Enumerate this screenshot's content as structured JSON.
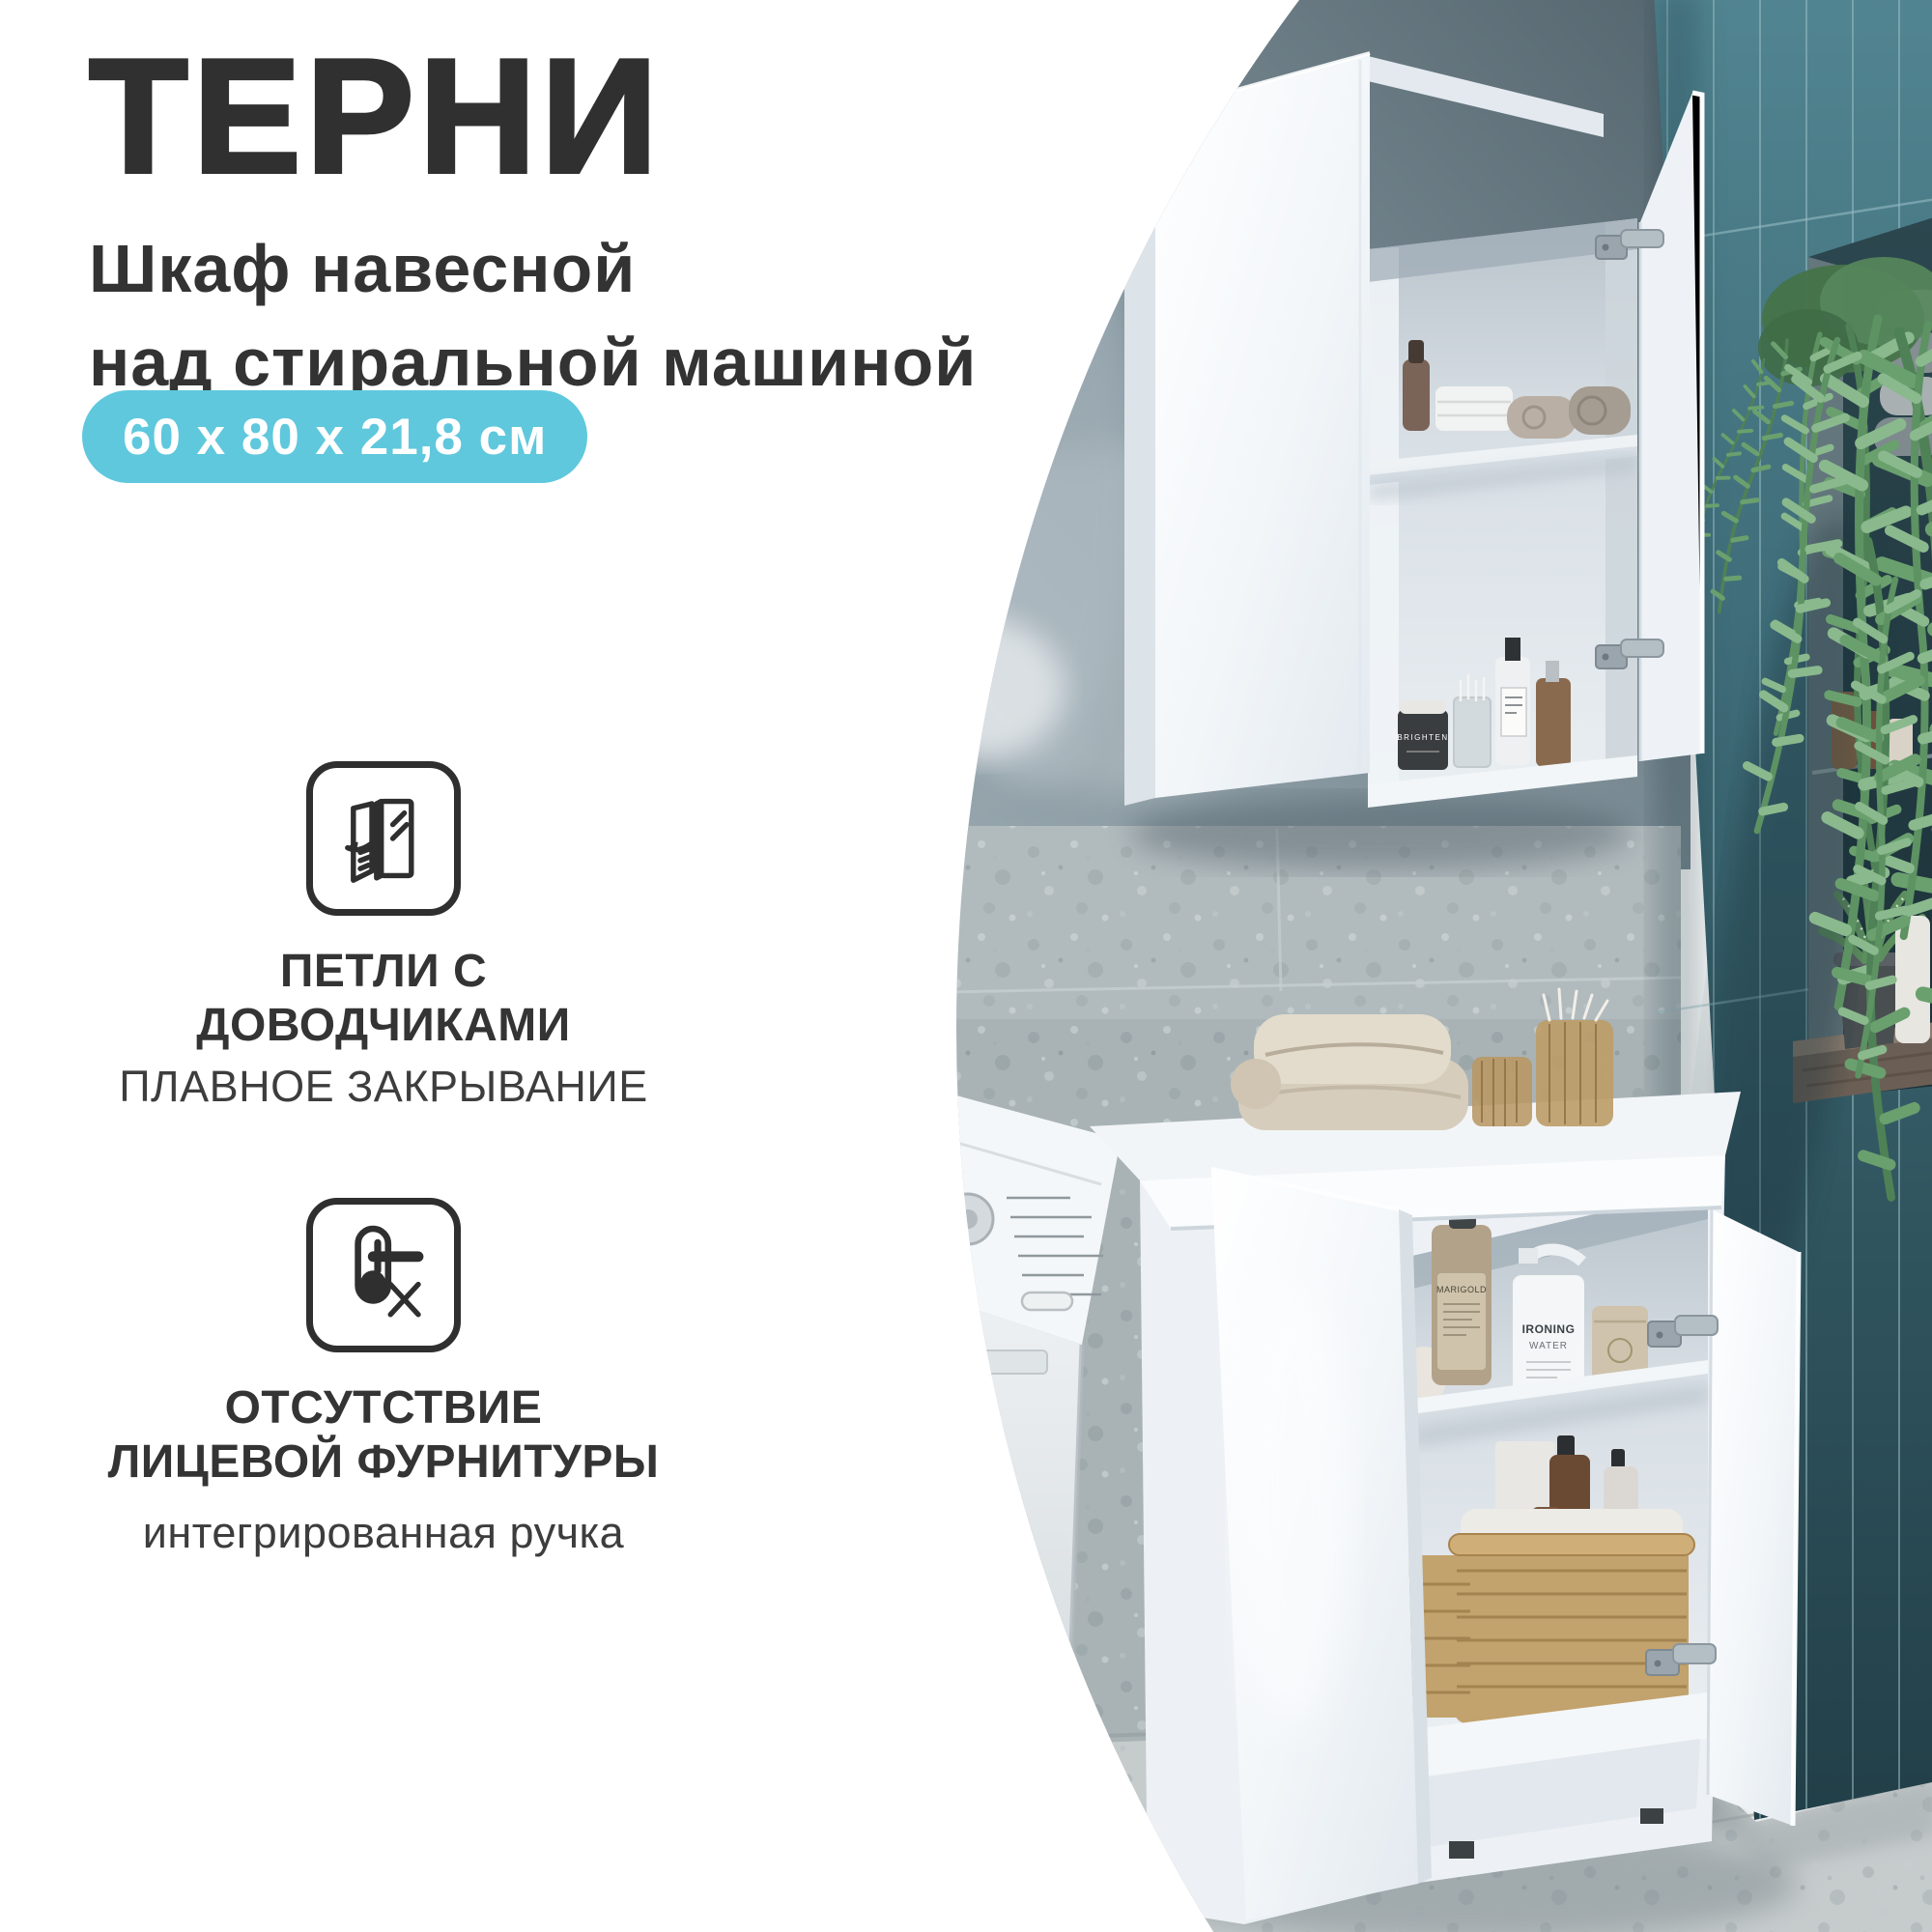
{
  "header": {
    "title": "ТЕРНИ",
    "subtitle_line1": "Шкаф навесной",
    "subtitle_line2": "над стиральной машиной"
  },
  "badge": {
    "text": "60 x 80 x 21,8 см"
  },
  "features": [
    {
      "icon": "soft-close-hinge-icon",
      "title": "ПЕТЛИ С ДОВОДЧИКАМИ",
      "subtitle": "ПЛАВНОЕ ЗАКРЫВАНИЕ"
    },
    {
      "icon": "no-front-hardware-icon",
      "title_line1": "ОТСУТСТВИЕ",
      "title_line2": "ЛИЦЕВОЙ ФУРНИТУРЫ",
      "subtitle": "интегрированная ручка"
    }
  ],
  "photo": {
    "labels": {
      "bottle_brand": "MARIGOLD",
      "spray_line1": "IRONING",
      "spray_line2": "WATER",
      "jar_brand": "BRIGHTEN"
    }
  },
  "colors": {
    "accent_badge": "#5fc8dd",
    "title_text": "#303030",
    "body_text": "#3a3a3a",
    "teal_tile": "#3f6d79",
    "grey_wall": "#7c8d96",
    "terrazzo_wall": "#a9b3b6",
    "floor": "#c6cbcc",
    "cabinet_white": "#f2f5f8"
  }
}
